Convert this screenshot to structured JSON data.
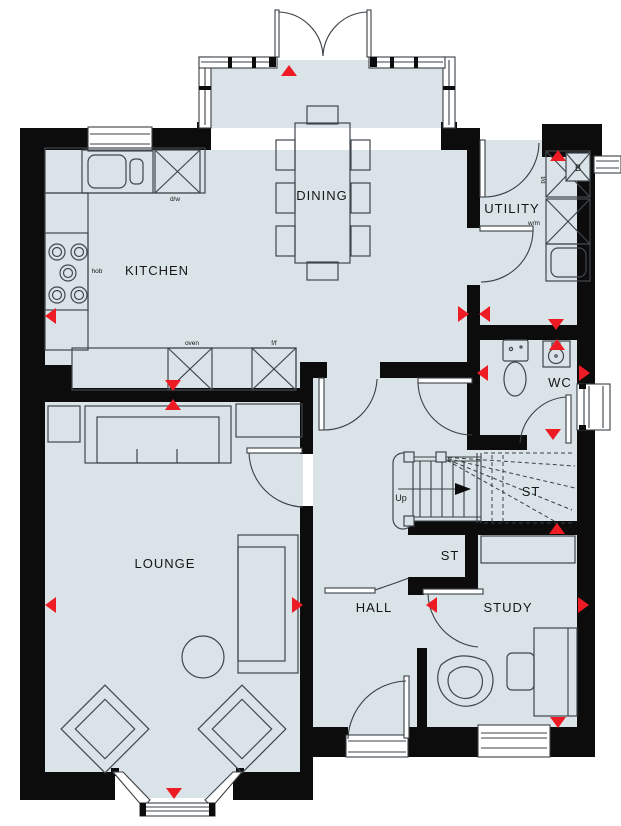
{
  "floorplan": {
    "rooms": {
      "kitchen": "KITCHEN",
      "dining": "DINING",
      "utility": "UTILITY",
      "wc": "WC",
      "lounge": "LOUNGE",
      "hall": "HALL",
      "study": "STUDY",
      "store_hall": "ST",
      "store_stairs": "ST"
    },
    "appliances": {
      "hob": "hob",
      "dishwasher": "d/w",
      "oven": "oven",
      "fridge_freezer": "f/f",
      "washing_machine": "w/m",
      "tumble_dryer": "t/d",
      "boiler": "B"
    },
    "stairs": {
      "direction": "Up"
    },
    "colors": {
      "floor": "#d9e3e8",
      "wall": "#0c0c0c",
      "line": "#3a4045",
      "marker": "#ed1c24",
      "background": "#ffffff"
    },
    "markers": {
      "count": 19,
      "shape": "triangle"
    }
  }
}
